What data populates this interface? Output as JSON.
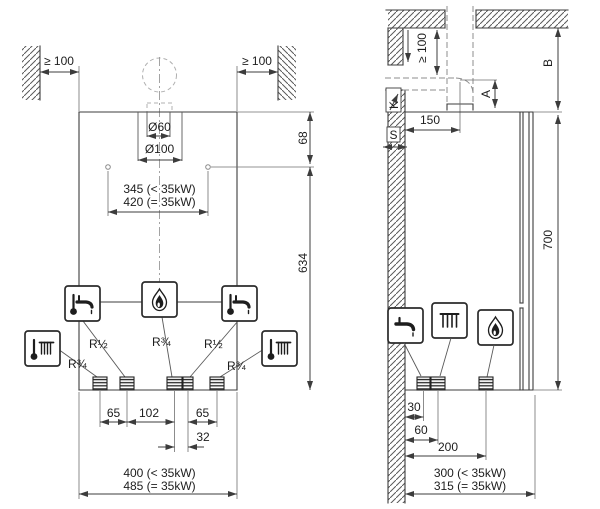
{
  "colors": {
    "background": "#ffffff",
    "line": "#3c3c3c",
    "light_line": "#b0b0b0"
  },
  "front": {
    "clearance_left": "≥ 100",
    "clearance_right": "≥ 100",
    "flue_inner": "Ø60",
    "flue_outer": "Ø100",
    "dim_top_to_holes": "68",
    "dim_holes_to_bottom": "634",
    "holes_line1": "345 (< 35kW)",
    "holes_line2": "420 (= 35kW)",
    "pipe1": "R¾",
    "pipe2": "R½",
    "pipe3": "R¾",
    "pipe4": "R½",
    "pipe5": "R¾",
    "spacing1": "65",
    "spacing2": "102",
    "spacing3": "65",
    "spacing4": "32",
    "width_line1": "400 (< 35kW)",
    "width_line2": "485 (= 35kW)"
  },
  "side": {
    "clearance_top": "≥ 100",
    "dim_a": "A",
    "dim_b": "B",
    "label_k": "K",
    "label_s": "S",
    "flue_offset": "150",
    "height": "700",
    "depth1": "30",
    "depth2": "60",
    "depth3": "200",
    "depth_line1": "300 (< 35kW)",
    "depth_line2": "315 (= 35kW)"
  },
  "icons": {
    "hot_water": "thermometer-tap-icon",
    "heating": "thermometer-radiator-icon",
    "gas": "flame-icon",
    "water_tap": "tap-icon",
    "radiator": "radiator-icon"
  }
}
